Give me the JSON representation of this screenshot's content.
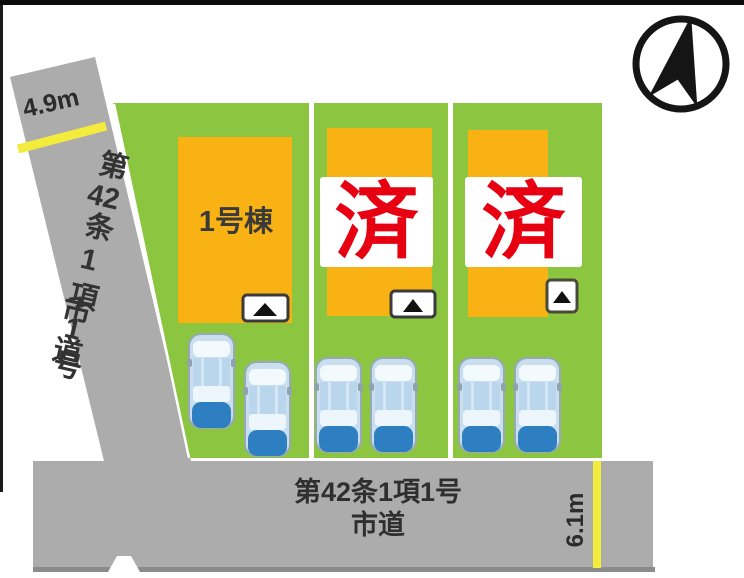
{
  "plan_title": "lot-layout-site-plan",
  "left_road": {
    "width_label": "4.9m",
    "name_prefix": "第",
    "name_number": "42",
    "name_suffix": "条1項1号",
    "type_label": "市道"
  },
  "bottom_road": {
    "name_line": "第42条1項1号",
    "type_label": "市道",
    "width_label": "6.1m"
  },
  "lots": [
    {
      "id": "lot-1",
      "building_label": "1号棟",
      "sold": false
    },
    {
      "id": "lot-2",
      "sold": true,
      "sold_label": "済"
    },
    {
      "id": "lot-3",
      "sold": true,
      "sold_label": "済"
    }
  ],
  "icons": {
    "compass": "north-arrow-in-circle",
    "entrance_marker": "black-triangle-up",
    "car": "top-view-blue-car"
  },
  "colors": {
    "lot_green": "#8CC640",
    "building_orange": "#F9B214",
    "road_gray": "#ACACAC",
    "road_edge_gray": "#8B8B8B",
    "width_marker_yellow": "#F3EC3D",
    "sold_red": "#E60012",
    "car_blue": "#2E7FC2",
    "border_black": "#0A0A0A"
  }
}
